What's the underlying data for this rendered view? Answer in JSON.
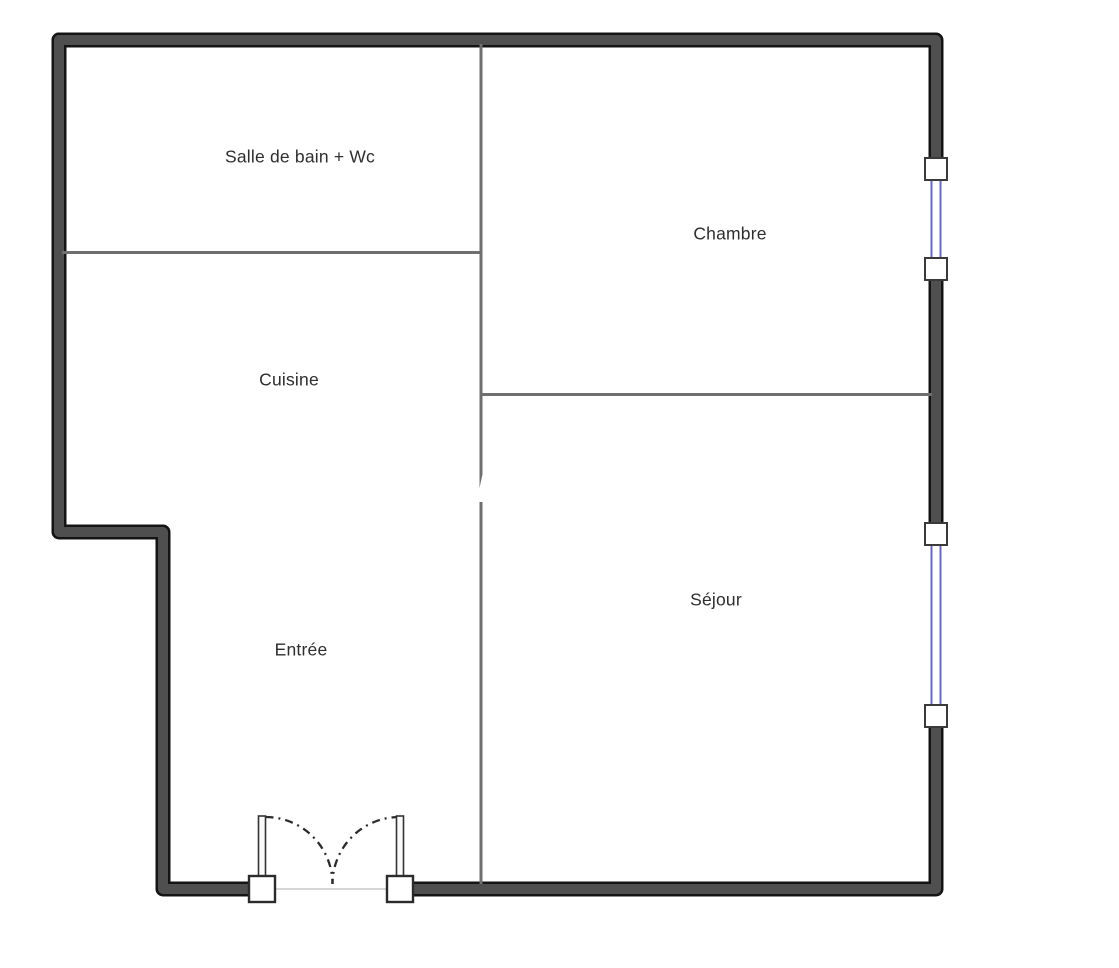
{
  "rooms": [
    {
      "label": "Salle de bain + Wc"
    },
    {
      "label": "Chambre"
    },
    {
      "label": "Cuisine"
    },
    {
      "label": "Séjour"
    },
    {
      "label": "Entrée"
    }
  ],
  "fixtures": [
    {
      "name": "window-right-upper"
    },
    {
      "name": "window-right-lower"
    },
    {
      "name": "entry-double-door"
    }
  ],
  "watermark": "W",
  "colors": {
    "wall_fill": "#4f4f4f",
    "wall_border": "#141414",
    "interior_wall": "#6f6f6f",
    "window_glass": "#6868bd",
    "window_frame": "#3a3a3a",
    "door_line": "#2b2b2b",
    "label_text": "#2e2e2e",
    "background": "#ffffff"
  }
}
